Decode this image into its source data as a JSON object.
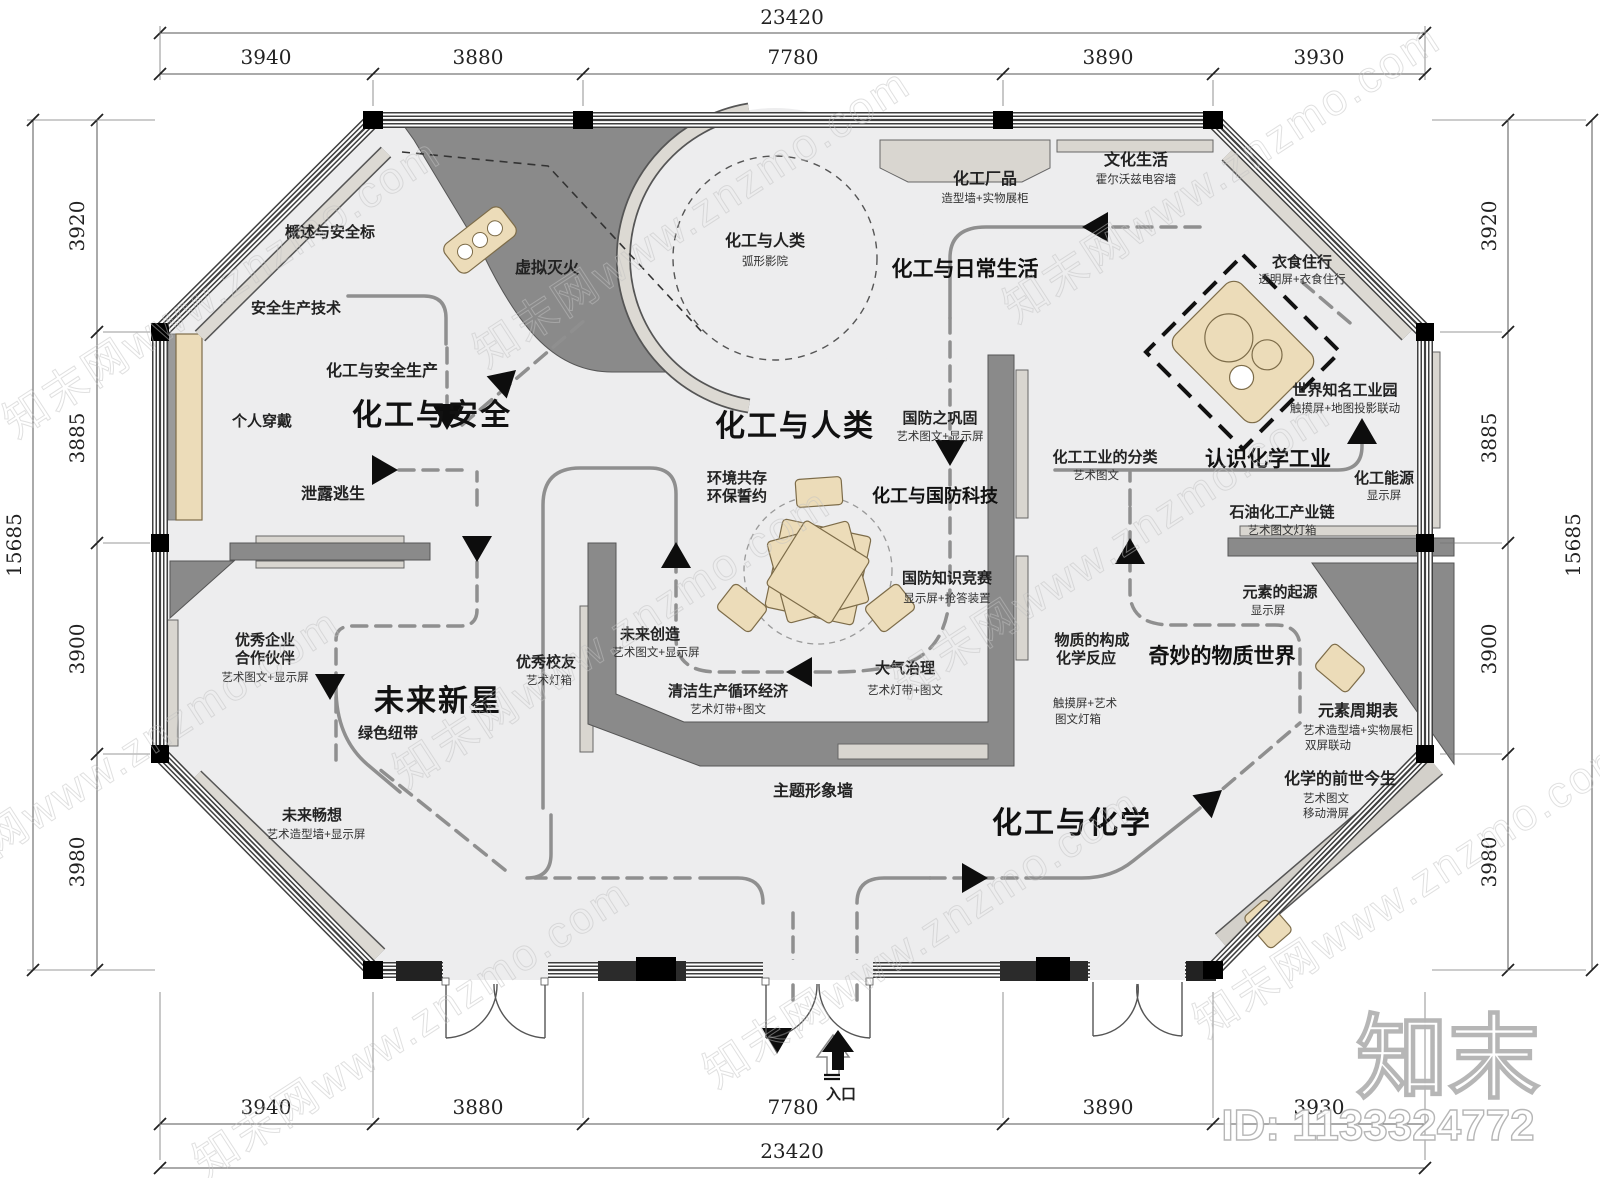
{
  "watermark": {
    "tile": "知末网www.znzmo.com",
    "logo": "知末",
    "id_text": "ID: 1133324772"
  },
  "dimensions": {
    "top_total": "23420",
    "bottom_total": "23420",
    "left_total": "15685",
    "right_total": "15685",
    "top_segments": [
      "3940",
      "3880",
      "7780",
      "3890",
      "3930"
    ],
    "bottom_segments": [
      "3940",
      "3880",
      "7780",
      "3890",
      "3930"
    ],
    "left_segments": [
      "3920",
      "3885",
      "3900",
      "3980"
    ],
    "right_segments": [
      "3920",
      "3885",
      "3900",
      "3980"
    ]
  },
  "entrance": {
    "label": "入口"
  },
  "zones": {
    "safety": "化工与安全",
    "humanity": "化工与人类",
    "future_star": "未来新星",
    "chemistry": "化工与化学",
    "daily_life": "化工与日常生活",
    "know_industry": "认识化学工业",
    "wonder_world": "奇妙的物质世界",
    "defense_tech": "化工与国防科技"
  },
  "exhibits": {
    "overview": {
      "title": "概述与安全标"
    },
    "vr_fire": {
      "title": "虚拟灭火"
    },
    "safe_tech": {
      "title": "安全生产技术"
    },
    "safe_prod": {
      "title": "化工与安全生产"
    },
    "personal_wear": {
      "title": "个人穿戴"
    },
    "leak_escape": {
      "title": "泄露逃生"
    },
    "partner": {
      "line1": "优秀企业",
      "line2": "合作伙伴",
      "sub": "艺术图文+显示屏"
    },
    "alumni": {
      "title": "优秀校友",
      "sub": "艺术灯箱"
    },
    "green_ribbon": {
      "title": "绿色纽带"
    },
    "future_vision": {
      "title": "未来畅想",
      "sub": "艺术造型墙+显示屏"
    },
    "cinema": {
      "title": "化工与人类",
      "sub": "弧形影院"
    },
    "products": {
      "title": "化工厂品",
      "sub": "造型墙+实物展柜"
    },
    "culture": {
      "title": "文化生活",
      "sub": "霍尔沃兹电容墙"
    },
    "clothing": {
      "title": "衣食住行",
      "sub": "透明屏+衣食住行"
    },
    "park": {
      "title": "世界知名工业园",
      "sub": "触摸屏+地图投影联动"
    },
    "energy": {
      "title": "化工能源",
      "sub": "显示屏"
    },
    "petro": {
      "title": "石油化工产业链",
      "sub": "艺术图文灯箱"
    },
    "classify": {
      "title": "化工工业的分类",
      "sub": "艺术图文"
    },
    "defense_solid": {
      "title": "国防之巩固",
      "sub": "艺术图文+显示屏"
    },
    "defense_quiz": {
      "title": "国防知识竞赛",
      "sub": "显示屏+抢答装置"
    },
    "env": {
      "line1": "环境共存",
      "line2": "环保誓约"
    },
    "future_create": {
      "title": "未来创造",
      "sub": "艺术图文+显示屏"
    },
    "clean": {
      "title": "清洁生产循环经济",
      "sub": "艺术灯带+图文"
    },
    "air": {
      "title": "大气治理",
      "sub": "艺术灯带+图文"
    },
    "matter": {
      "line1": "物质的构成",
      "line2": "化学反应",
      "sub1": "触摸屏+艺术",
      "sub2": "图文灯箱"
    },
    "element_origin": {
      "title": "元素的起源",
      "sub": "显示屏"
    },
    "periodic": {
      "title": "元素周期表",
      "sub1": "艺术造型墙+实物展柜",
      "sub2": "双屏联动"
    },
    "history": {
      "title": "化学的前世今生",
      "sub1": "艺术图文",
      "sub2": "移动滑屏"
    },
    "theme_wall": {
      "title": "主题形象墙"
    }
  }
}
